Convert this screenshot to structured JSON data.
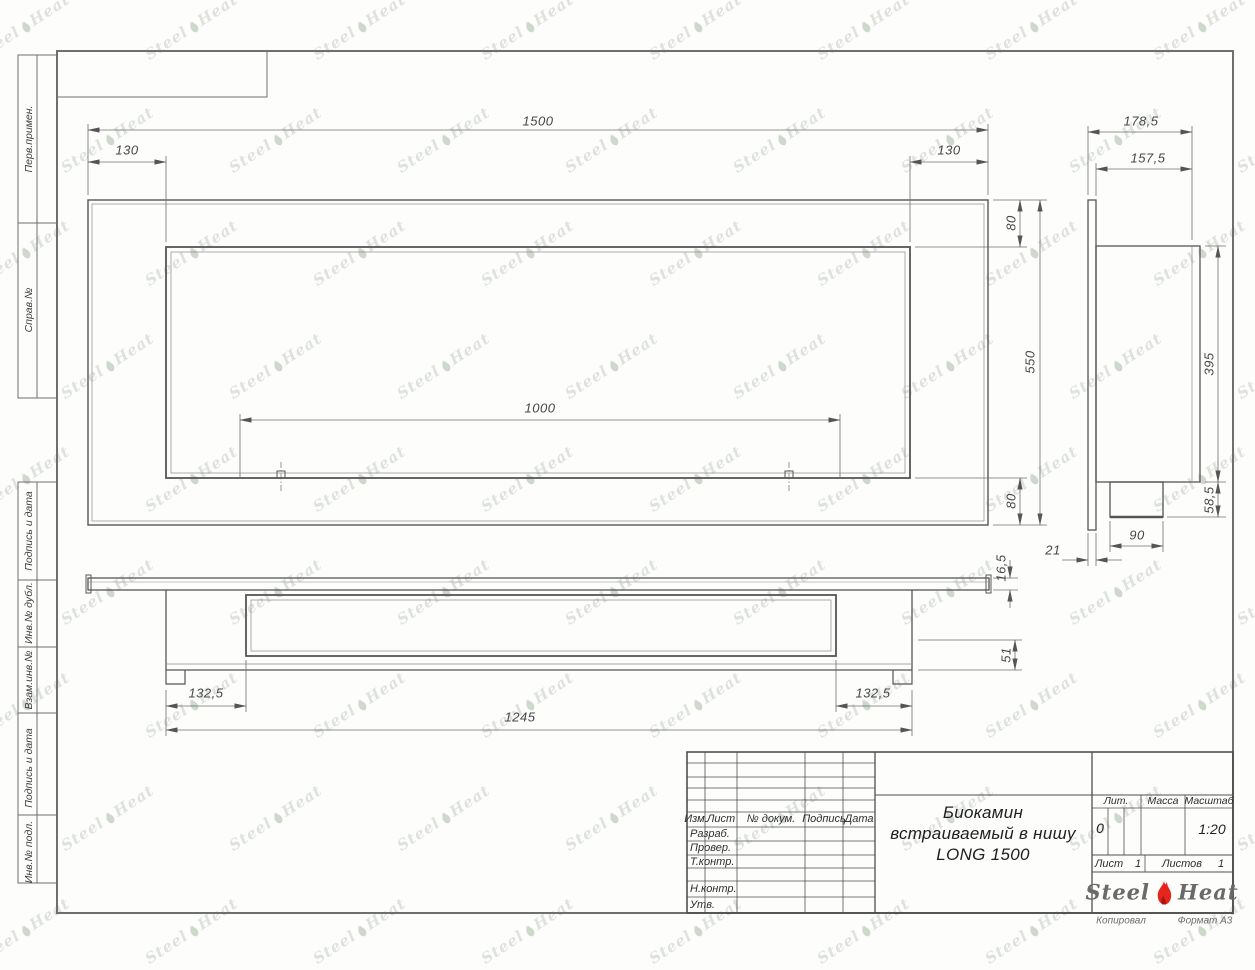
{
  "sheet": {
    "copied_label": "Копировал",
    "format_label": "Формат А3"
  },
  "watermark": {
    "steel": "Steel",
    "heat": "Heat"
  },
  "margin_labels": {
    "perv": "Перв.примен.",
    "sprav": "Справ.№",
    "podpis1": "Подпись и дата",
    "inv_dubl": "Инв.№ дубл.",
    "vzam": "Взам.инв.№",
    "podpis2": "Подпись и дата",
    "inv_podl": "Инв.№ подл."
  },
  "title_block": {
    "izm": "Изм.",
    "list_col": "Лист",
    "doc_col": "№ докум.",
    "podpis_col": "Подпись",
    "data_col": "Дата",
    "razrab": "Разраб.",
    "prover": "Провер.",
    "tkontr": "Т.контр.",
    "nkontr": "Н.контр.",
    "utv": "Утв.",
    "title_line1": "Биокамин",
    "title_line2": "встраиваемый в нишу",
    "title_line3": "LONG 1500",
    "lit_label": "Лит.",
    "lit_value": "0",
    "mass_label": "Масса",
    "scale_label": "Масштаб",
    "scale_value": "1:20",
    "sheet_label": "Лист",
    "sheet_value": "1",
    "sheets_label": "Листов",
    "sheets_value": "1",
    "logo_steel": "Steel",
    "logo_heat": "Heat"
  },
  "dimensions": {
    "front": {
      "width": "1500",
      "left_offset": "130",
      "right_offset": "130",
      "top_margin": "80",
      "height": "550",
      "bottom_margin": "80",
      "opening": "1000"
    },
    "side": {
      "total_depth": "178,5",
      "body_depth": "157,5",
      "body_height": "395",
      "tray_height": "58,5",
      "tray_width": "90",
      "panel_thickness": "21"
    },
    "bottom": {
      "flange_thickness": "16,5",
      "inner_depth": "51",
      "left_offset": "132,5",
      "right_offset": "132,5",
      "body_length": "1245"
    }
  }
}
